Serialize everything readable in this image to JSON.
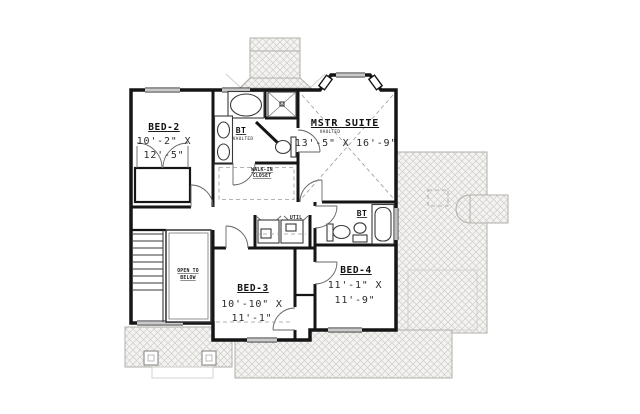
{
  "plan": {
    "rooms": {
      "bed2": {
        "name": "BED-2",
        "dims": [
          "10'-2\" X",
          "12'-5\""
        ]
      },
      "mbath": {
        "name": "BT",
        "sub": "VAULTED"
      },
      "master": {
        "name": "MSTR SUITE",
        "sub": "VAULTED",
        "dim": "13'-5\" X 16'-9\""
      },
      "wic": {
        "lines": [
          "WALK-IN",
          "CLOSET"
        ]
      },
      "stair": {
        "lines": [
          "OPEN TO",
          "BELOW"
        ]
      },
      "bath2": {
        "name": "BT"
      },
      "util": {
        "name": "UTIL"
      },
      "bed3": {
        "name": "BED-3",
        "dims": [
          "10'-10\" X",
          "11'-1\""
        ]
      },
      "bed4": {
        "name": "BED-4",
        "dims": [
          "11'-1\" X",
          "11'-9\""
        ]
      }
    },
    "colors": {
      "ink": "#151515",
      "roof_fill": "#f4f3f1",
      "roof_line": "#cfcdc8"
    }
  }
}
